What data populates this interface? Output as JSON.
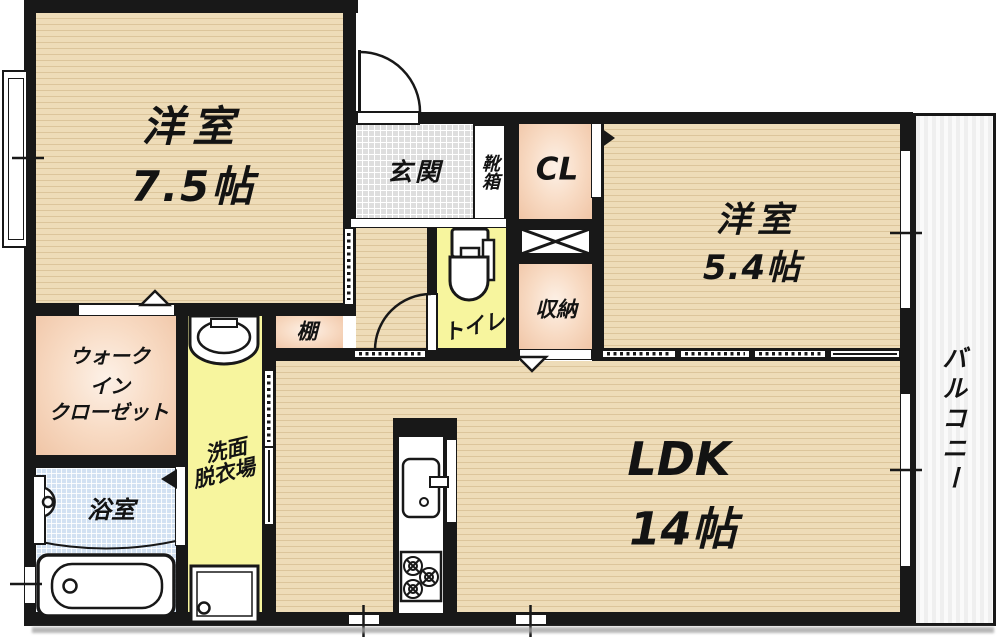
{
  "plan": {
    "title": "apartment-floor-plan",
    "rooms": {
      "western_room_75": {
        "name": "洋室",
        "size": "7.5帖"
      },
      "entrance": {
        "name": "玄関"
      },
      "shoe_box": {
        "name": "靴箱"
      },
      "closet": {
        "name": "CL"
      },
      "western_room_54": {
        "name": "洋室",
        "size": "5.4帖"
      },
      "toilet": {
        "name": "トイレ"
      },
      "storage": {
        "name": "収納"
      },
      "shelf": {
        "name": "棚"
      },
      "walk_in_closet": {
        "line1": "ウォーク",
        "line2": "イン",
        "line3": "クローゼット"
      },
      "washroom": {
        "line1": "洗面",
        "line2": "脱衣場"
      },
      "bathroom": {
        "name": "浴室"
      },
      "ldk": {
        "name": "LDK",
        "size": "14帖"
      },
      "balcony": {
        "name": "バルコニー"
      }
    },
    "colors": {
      "wall": "#181818",
      "wood_floor": "#eedcb8",
      "closet_salmon": "#f0c5a6",
      "wet_area_yellow": "#f7f59e",
      "entrance_gray": "#dedede",
      "bathroom_blue": "#d2e1f2",
      "balcony_stripe": "#efefef"
    }
  }
}
